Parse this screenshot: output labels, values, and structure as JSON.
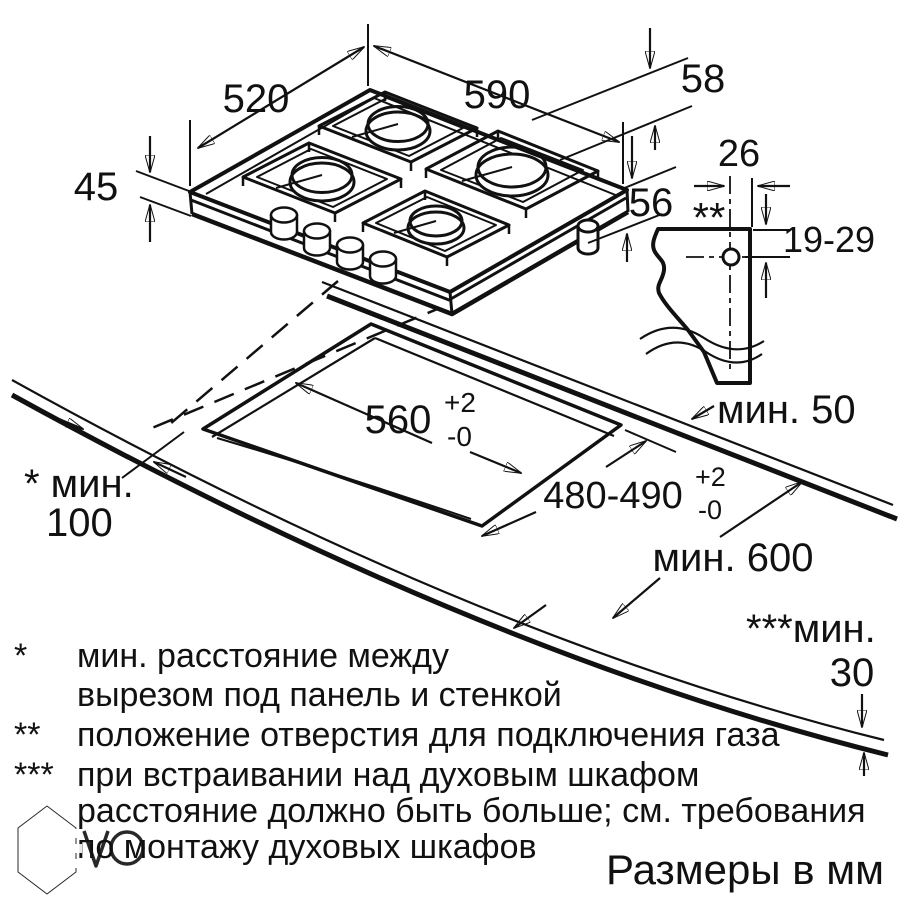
{
  "drawing_title": "Схема установки газовой варочной панели",
  "dimensions": {
    "hob_width": "590",
    "hob_depth": "520",
    "hob_front_height": "45",
    "hob_total_height": "58",
    "hob_box_height": "56"
  },
  "gas_connection": {
    "offset_from_edge": "26",
    "marker": "**",
    "hole_height_range": "19-29"
  },
  "cutout": {
    "width": "560",
    "depth": "480-490",
    "tolerance_plus": "+2",
    "tolerance_minus": "-0"
  },
  "clearances": {
    "back_min": "мин. 50",
    "worktop_depth_min": "мин. 600",
    "wall_min_label": "* мин.",
    "wall_min_value": "100",
    "oven_min_label": "***мин.",
    "oven_min_value": "30"
  },
  "footnotes": [
    {
      "marker": "*",
      "text": "мин. расстояние между"
    },
    {
      "marker": "",
      "text": "вырезом под панель и стенкой"
    },
    {
      "marker": "**",
      "text": "положение отверстия для подключения газа"
    },
    {
      "marker": "***",
      "text": "при встраивании над духовым шкафом"
    },
    {
      "marker": "",
      "text": "расстояние должно быть больше; см. требования"
    },
    {
      "marker": "",
      "text": "по монтажу духовых шкафов"
    }
  ],
  "units_note": "Размеры в мм",
  "watermark": {
    "v": "V",
    "o": ""
  },
  "colors": {
    "ink": "#111111",
    "muted_text": "#7d7d7d",
    "burner_cap": "#b5b5b5",
    "watermark": "#8f8f8f"
  }
}
